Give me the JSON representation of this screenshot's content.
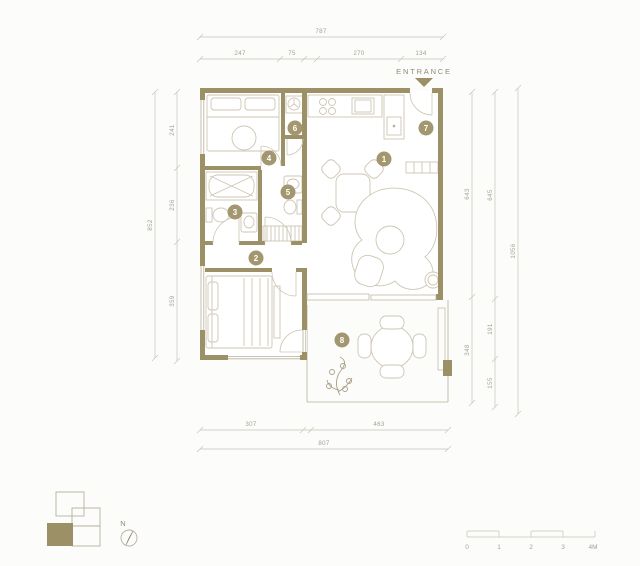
{
  "title": "Apartment floor plan",
  "entrance": {
    "label": "ENTRANCE"
  },
  "compass": {
    "label": "N"
  },
  "scale_bar": {
    "labels": [
      "0",
      "1",
      "2",
      "3",
      "4M"
    ]
  },
  "dimensions": {
    "top": {
      "total": "787",
      "segments": [
        "247",
        "75",
        "270",
        "134"
      ]
    },
    "left": {
      "total": "852",
      "segments": [
        "241",
        "236",
        "359"
      ]
    },
    "right": {
      "total": "1056",
      "inner": [
        "643",
        "348"
      ],
      "middle": [
        "645",
        "191",
        "155"
      ]
    },
    "bottom": {
      "total": "807",
      "segments": [
        "307",
        "463"
      ]
    }
  },
  "rooms": {
    "markers": [
      "1",
      "2",
      "3",
      "4",
      "5",
      "6",
      "7",
      "8"
    ]
  },
  "colors": {
    "wall": "#9c9066",
    "marker": "#a39770",
    "dim_line": "#c6c3b7",
    "dim_text": "#a5a195",
    "furniture": "#cdc6b3",
    "furniture_dark": "#b5ae98",
    "entrance_text": "#8f8b76",
    "plant": "#a9a186",
    "key_outline": "#b7b09c",
    "bg": "#fcfcfa"
  }
}
